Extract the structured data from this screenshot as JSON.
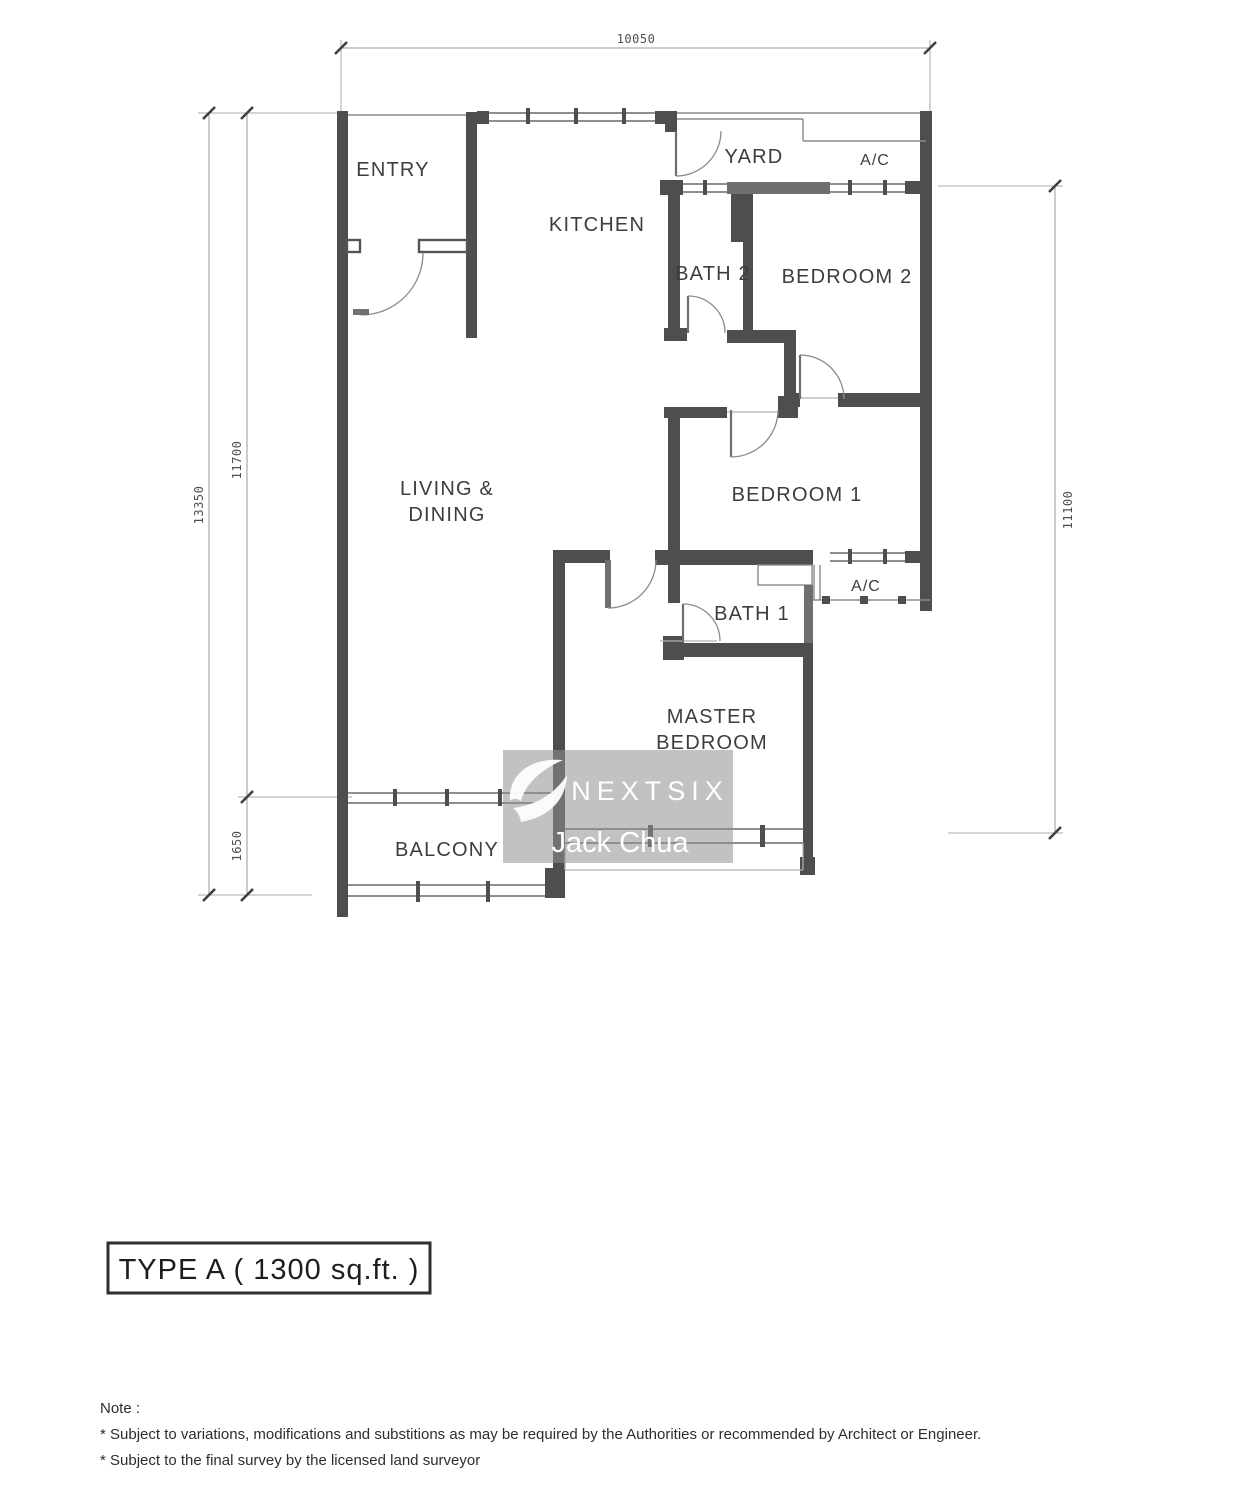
{
  "rooms": {
    "entry": "ENTRY",
    "kitchen": "KITCHEN",
    "yard": "YARD",
    "ac_top": "A/C",
    "bath2": "BATH 2",
    "bedroom2": "BEDROOM 2",
    "living_line1": "LIVING &",
    "living_line2": "DINING",
    "bedroom1": "BEDROOM 1",
    "bath1": "BATH 1",
    "ac_bottom": "A/C",
    "master_line1": "MASTER",
    "master_line2": "BEDROOM",
    "balcony": "BALCONY"
  },
  "dimensions": {
    "top": "10050",
    "left_outer": "13350",
    "left_inner": "11700",
    "left_lower": "1650",
    "right": "11100"
  },
  "watermark": {
    "brand": "NEXTSIX",
    "agent": "Jack Chua"
  },
  "plan_title": "TYPE A ( 1300 sq.ft. )",
  "note": {
    "heading": "Note :",
    "line1": "* Subject to variations, modifications and substitions as may be required by the Authorities or recommended by Architect or Engineer.",
    "line2": "* Subject to the final survey by the licensed land surveyor"
  },
  "colors": {
    "wall": "#4e4e4e",
    "wall_medium": "#6f6f6f",
    "thin_line": "#8a8a8a",
    "text": "#3d3d3d",
    "watermark_bg": "#8f8f8f",
    "watermark_text": "#ffffff"
  }
}
